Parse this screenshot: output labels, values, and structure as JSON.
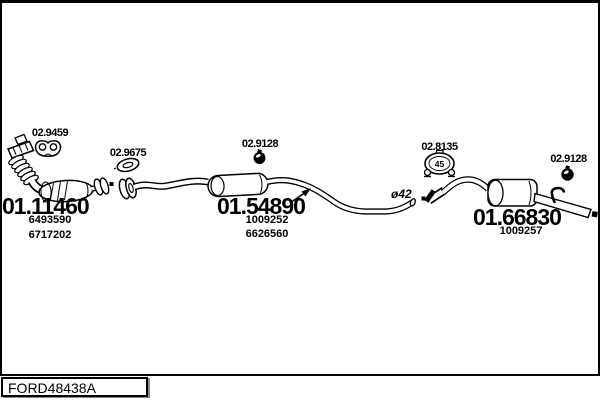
{
  "window": {
    "background_color": "#ffffff",
    "line_color": "#000000"
  },
  "footer": {
    "code": "FORD48438A"
  },
  "diagram": {
    "parts": [
      {
        "number": "01.11460",
        "refs": [
          "6493590",
          "6717202"
        ]
      },
      {
        "number": "01.54890",
        "refs": [
          "1009252",
          "6626560"
        ]
      },
      {
        "number": "01.66830",
        "refs": [
          "1009257"
        ]
      }
    ],
    "fittings": [
      {
        "number": "02.9459",
        "icon": "flange-gasket-icon"
      },
      {
        "number": "02.9675",
        "icon": "ring-gasket-icon"
      },
      {
        "number": "02.9128",
        "icon": "pipe-clamp-icon"
      },
      {
        "number": "02.8135",
        "icon": "mounting-clamp-icon",
        "diameter": "45"
      },
      {
        "number": "02.9128",
        "icon": "pipe-clamp-icon"
      }
    ],
    "annotations": {
      "pipe_diameter": "ø42"
    }
  }
}
